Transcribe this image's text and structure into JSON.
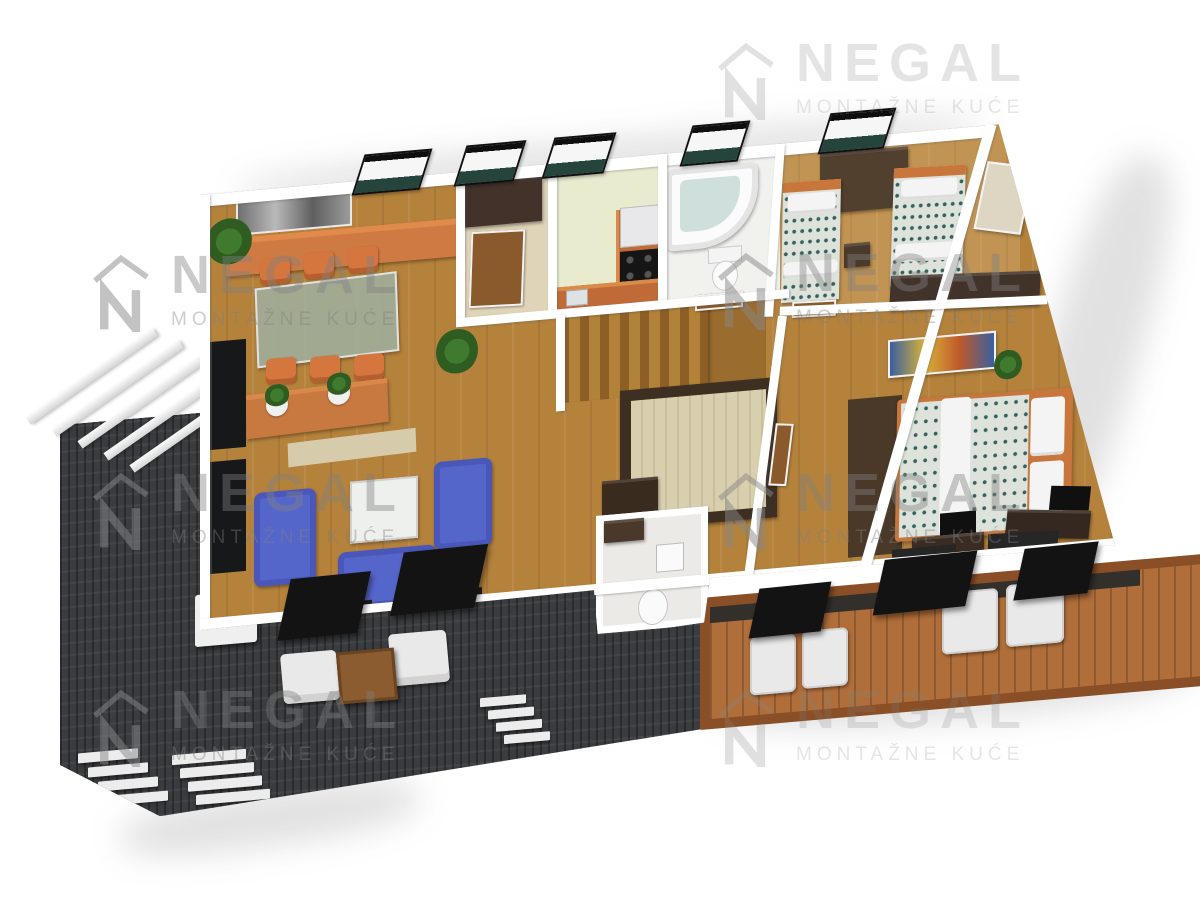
{
  "watermark": {
    "brand": "NEGAL",
    "tagline": "MONTAŽNE KUĆE",
    "logo_icon": "negal-house-logo",
    "color": "#808080",
    "instances": [
      {
        "left": 718,
        "top": 38,
        "faint": true
      },
      {
        "left": 93,
        "top": 250,
        "faint": false
      },
      {
        "left": 718,
        "top": 248,
        "faint": false
      },
      {
        "left": 93,
        "top": 468,
        "faint": false
      },
      {
        "left": 718,
        "top": 468,
        "faint": false
      },
      {
        "left": 93,
        "top": 685,
        "faint": false
      },
      {
        "left": 718,
        "top": 685,
        "faint": true
      }
    ]
  },
  "scene": {
    "type": "3d-floor-plan-render",
    "view": "top-down-perspective",
    "rooms": [
      {
        "name": "living-dining-room",
        "floor": "golden-oak-wood",
        "items": [
          "gray-wall-art",
          "window",
          "orange-sideboard",
          "glass-dining-table",
          "orange-dining-chair x6",
          "low-media-bench",
          "potted-plant x4",
          "black-wall-tv-panels",
          "blue-sofa x2",
          "blue-armchair",
          "white-coffee-table",
          "floor-cushions",
          "glass-doors-to-terrace"
        ]
      },
      {
        "name": "entrance-hall",
        "floor": "light-wood",
        "items": [
          "dark-wardrobe",
          "wood-door",
          "window"
        ]
      },
      {
        "name": "kitchen",
        "floor": "pale-green",
        "items": [
          "orange-l-counter",
          "black-cooktop",
          "extractor-hood",
          "sink",
          "window"
        ]
      },
      {
        "name": "bathroom",
        "floor": "white-tile",
        "items": [
          "corner-jacuzzi-tub",
          "toilet",
          "window"
        ]
      },
      {
        "name": "kids-bedroom",
        "floor": "oak-wood",
        "items": [
          "single-bed-teal-pattern x2",
          "dark-desk",
          "stool",
          "long-dresser",
          "wall-picture",
          "window"
        ]
      },
      {
        "name": "hallway-staircase",
        "floor": "oak-wood",
        "items": [
          "l-shaped-wood-stairs",
          "walk-in-closet",
          "brown-sideboard",
          "doors"
        ]
      },
      {
        "name": "wc",
        "floor": "white-tile",
        "items": [
          "toilet",
          "sink",
          "vanity"
        ]
      },
      {
        "name": "master-bedroom",
        "floor": "oak-wood",
        "items": [
          "double-bed-teal-pattern",
          "white-pillow x2",
          "white-bed-runner",
          "dark-brown-rug",
          "colorful-wall-art",
          "plant",
          "desk x2",
          "black-chair x2",
          "glass-doors-to-balcony"
        ]
      },
      {
        "name": "wood-balcony",
        "floor": "reddish-wood-deck",
        "items": [
          "white-lounge-chair x4",
          "black-sling-chair x3",
          "wood-railing"
        ]
      },
      {
        "name": "stone-terrace",
        "floor": "dark-stone",
        "items": [
          "white-pergola-slats",
          "white-cube-chair x2",
          "black-sling-chair x2",
          "wood-coffee-table",
          "white-planter",
          "wood-grate-bench",
          "step-group x3"
        ]
      }
    ],
    "palette": {
      "wood_floor": "#b5823c",
      "kitchen_floor": "#e9ebcf",
      "terrace_stone": "#3a3c3f",
      "balcony_wood": "#b06e3a",
      "sofa_blue": "#5566cb",
      "accent_orange": "#d4763e",
      "wall_white": "#ffffff",
      "dark_furniture": "#3f3022",
      "bed_pattern_teal": "#33605c"
    }
  }
}
